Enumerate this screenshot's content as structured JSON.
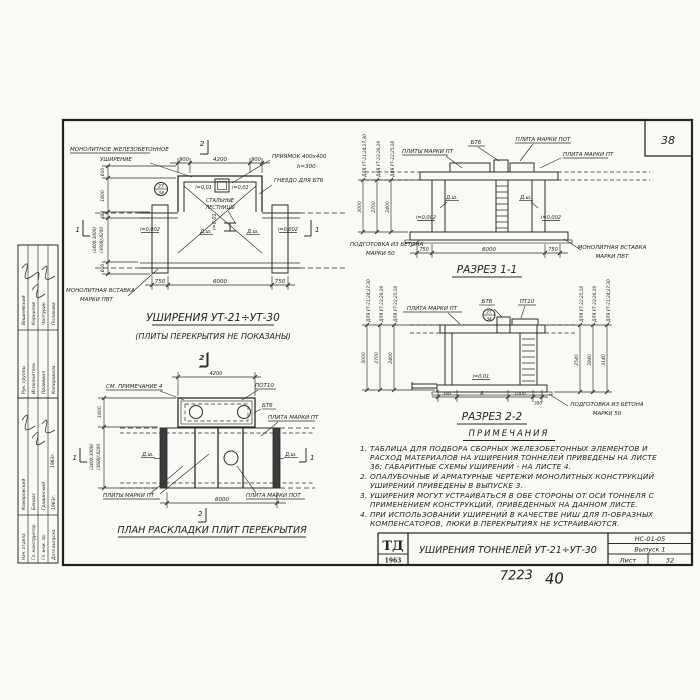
{
  "sheet": {
    "corner_number": "38",
    "logo_name": "ТД",
    "logo_year": "1963",
    "main_title": "УШИРЕНИЯ ТОННЕЛЕЙ УТ-21÷УТ-30",
    "stamp_code": "НС-01-05",
    "issue": "Выпуск 1",
    "sheet_word": "Лист",
    "sheet_number": "32",
    "handwritten_code": "7223",
    "handwritten_number": "40"
  },
  "stamp": {
    "rows_top": [
      {
        "role": "Рук. группы",
        "name": "Вишневский"
      },
      {
        "role": "Исполнитель",
        "name": "Корнилов"
      },
      {
        "role": "Проверил",
        "name": "Чалтурин"
      },
      {
        "role": "Копировала",
        "name": "Полякова"
      }
    ],
    "rows_bottom": [
      {
        "role": "Нач. отдела",
        "name": "Комаровский"
      },
      {
        "role": "Гл. конструктор",
        "name": "Бандас"
      },
      {
        "role": "Гл. инж. пр.",
        "name": "Градинский"
      },
      {
        "role": "Дата выпуска",
        "name": "1963г."
      }
    ],
    "year": "1963г."
  },
  "plan": {
    "label_monolithic_1": "МОНОЛИТНОЕ ЖЕЛЕЗОБЕТОННОЕ",
    "label_monolithic_2": "УШИРЕНИЕ",
    "label_pit_1": "ПРИЯМОК 400х400",
    "label_pit_2": "h=300",
    "label_socket": "ГНЕЗДО ДЛЯ БТ6",
    "label_stairs_1": "СТАЛЬНЫЕ",
    "label_stairs_2": "ЛЕСТНИЦЫ",
    "label_insert_1": "МОНОЛИТНАЯ ВСТАВКА",
    "label_insert_2": "МАРКИ ПВТ",
    "slope_pit": "i=0,01",
    "slope_floor": "i=0,002",
    "axis_mark": "Д.ш.",
    "callout_top": "27",
    "callout_bottom": "34",
    "dim_top_left": "900",
    "dim_top_mid": "4200",
    "dim_top_right": "900",
    "dim_bot_left": "750",
    "dim_bot_mid": "6000",
    "dim_bot_right": "750",
    "dim_600a": "600",
    "dim_1800": "1800",
    "dim_300": "300",
    "dim_var1": "(2400;3000)",
    "dim_var2": "(3600);4200",
    "dim_600b": "600",
    "mark1": "1",
    "mark2": "2",
    "title": "УШИРЕНИЯ УТ-21÷УТ-30",
    "subtitle": "(ПЛИТЫ ПЕРЕКРЫТИЯ НЕ ПОКАЗАНЫ)"
  },
  "s11": {
    "title": "РАЗРЕЗ 1-1",
    "label_bt6": "БТ6",
    "label_pot": "ПЛИТА МАРКИ ПОТ",
    "label_pt_pl": "ПЛИТЫ МАРКИ ПТ",
    "label_pt": "ПЛИТА МАРКИ ПТ",
    "label_insert_1": "МОНОЛИТНАЯ ВСТАВКА",
    "label_insert_2": "МАРКИ ПВТ",
    "label_prep_1": "ПОДГОТОВКА ИЗ БЕТОНА",
    "label_prep_2": "МАРКИ 50",
    "slope": "i=0,002",
    "axis_mark": "Д.ш.",
    "dims_left": [
      {
        "label": "ДЛЯ УТ-21;24;27;30",
        "value": "3000"
      },
      {
        "label": "ДЛЯ УТ-23;26;29",
        "value": "2700"
      },
      {
        "label": "ДЛЯ УТ-22;25;28",
        "value": "2400"
      }
    ],
    "dim_bot_left": "750",
    "dim_bot_mid": "6000",
    "dim_bot_right": "750"
  },
  "s22": {
    "title": "РАЗРЕЗ 2-2",
    "label_pt": "ПЛИТА МАРКИ ПТ",
    "label_bt6": "БТ6",
    "label_pt10": "ПТ10",
    "label_prep_1": "ПОДГОТОВКА ИЗ БЕТОНА",
    "label_prep_2": "МАРКИ 50",
    "slope": "i=0,01",
    "callout_top": "27",
    "callout_bottom": "34",
    "dims_left": [
      {
        "label": "ДЛЯ УТ-21;24;27;30",
        "value": "3000"
      },
      {
        "label": "ДЛЯ УТ-23;26;29",
        "value": "2700"
      },
      {
        "label": "ДЛЯ УТ-22;25;28",
        "value": "2400"
      }
    ],
    "dims_right": [
      {
        "label": "ДЛЯ УТ-22;25;28",
        "value": "2540"
      },
      {
        "label": "ДЛЯ УТ-23;26;29",
        "value": "2840"
      },
      {
        "label": "ДЛЯ УТ-21;24;27;30",
        "value": "3140"
      }
    ],
    "dims_bottom": [
      "300",
      "А",
      "1000",
      "300"
    ]
  },
  "plan2": {
    "title": "ПЛАН РАСКЛАДКИ ПЛИТ ПЕРЕКРЫТИЯ",
    "label_note": "СМ. ПРИМЕЧАНИЕ 4",
    "label_pot10": "ПОТ10",
    "label_bt6": "БТ6",
    "label_pt": "ПЛИТА МАРКИ ПТ",
    "label_pt_pl": "ПЛИТЫ МАРКИ ПТ",
    "label_pot": "ПЛИТА МАРКИ ПОТ",
    "axis_mark": "Д.ш.",
    "dim_4200": "4200",
    "dim_1800": "1800",
    "dim_var1": "(2400;3000)",
    "dim_var2": "(3600);4200",
    "dim_6000": "6000",
    "mark1": "1",
    "mark2": "2"
  },
  "notes": {
    "title": "ПРИМЕЧАНИЯ",
    "items": [
      {
        "num": "1.",
        "text": "ТАБЛИЦА ДЛЯ ПОДБОРА СБОРНЫХ ЖЕЛЕЗОБЕТОННЫХ ЭЛЕМЕНТОВ И РАСХОД МАТЕРИАЛОВ НА УШИРЕНИЯ ТОННЕЛЕЙ ПРИВЕДЕНЫ НА ЛИСТЕ 36; ГАБАРИТНЫЕ СХЕМЫ УШИРЕНИЙ - НА ЛИСТЕ 4."
      },
      {
        "num": "2.",
        "text": "ОПАЛУБОЧНЫЕ И АРМАТУРНЫЕ ЧЕРТЕЖИ МОНОЛИТНЫХ КОНСТРУКЦИЙ УШИРЕНИЙ ПРИВЕДЕНЫ В ВЫПУСКЕ 3."
      },
      {
        "num": "3.",
        "text": "УШИРЕНИЯ МОГУТ УСТРАИВАТЬСЯ В ОБЕ СТОРОНЫ ОТ ОСИ ТОННЕЛЯ С ПРИМЕНЕНИЕМ КОНСТРУКЦИЙ, ПРИВЕДЕННЫХ НА ДАННОМ ЛИСТЕ."
      },
      {
        "num": "4.",
        "text": "ПРИ ИСПОЛЬЗОВАНИИ УШИРЕНИЙ В КАЧЕСТВЕ НИШ ДЛЯ П-ОБРАЗНЫХ КОМПЕНСАТОРОВ, ЛЮКИ В ПЕРЕКРЫТИЯХ НЕ УСТРАИВАЮТСЯ."
      }
    ]
  }
}
